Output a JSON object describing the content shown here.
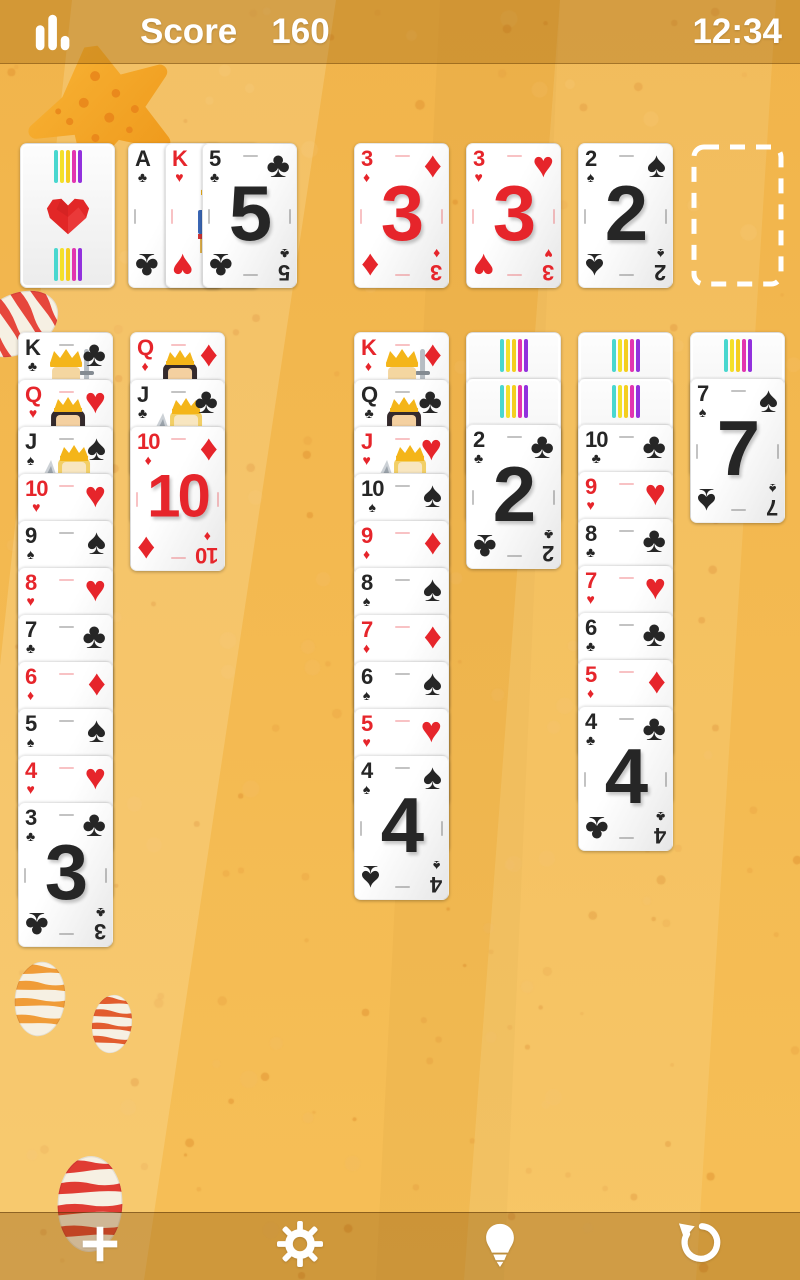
{
  "status_bar": {
    "stats_icon": "bar-chart-icon",
    "score_label": "Score",
    "score_value": "160",
    "time": "12:34"
  },
  "colors": {
    "background": "#f5bc55",
    "bar_overlay": "rgba(150,92,12,0.32)",
    "card_red": "#e6252b",
    "card_black": "#262626",
    "back_stripes": [
      "#49d7cf",
      "#f4e02a",
      "#f4ce1f",
      "#e234b0",
      "#9231dd"
    ],
    "back_heart": "#e22727",
    "empty_slot_dash": "#ffffff"
  },
  "stock": {
    "face_up": false,
    "design": "striped-back-red-heart"
  },
  "waste": [
    {
      "rank": "A",
      "suit": "clubs",
      "face_up": true
    },
    {
      "rank": "K",
      "suit": "hearts",
      "face_up": true
    },
    {
      "rank": "5",
      "suit": "clubs",
      "face_up": true
    }
  ],
  "foundations": [
    {
      "rank": "3",
      "suit": "diamonds",
      "face_up": true
    },
    {
      "rank": "3",
      "suit": "hearts",
      "face_up": true
    },
    {
      "rank": "2",
      "suit": "spades",
      "face_up": true
    },
    {
      "empty": true
    }
  ],
  "tableau": [
    [
      {
        "rank": "K",
        "suit": "clubs",
        "face_up": true
      },
      {
        "rank": "Q",
        "suit": "hearts",
        "face_up": true
      },
      {
        "rank": "J",
        "suit": "spades",
        "face_up": true
      },
      {
        "rank": "10",
        "suit": "hearts",
        "face_up": true
      },
      {
        "rank": "9",
        "suit": "spades",
        "face_up": true
      },
      {
        "rank": "8",
        "suit": "hearts",
        "face_up": true
      },
      {
        "rank": "7",
        "suit": "clubs",
        "face_up": true
      },
      {
        "rank": "6",
        "suit": "diamonds",
        "face_up": true
      },
      {
        "rank": "5",
        "suit": "spades",
        "face_up": true
      },
      {
        "rank": "4",
        "suit": "hearts",
        "face_up": true
      },
      {
        "rank": "3",
        "suit": "clubs",
        "face_up": true
      }
    ],
    [
      {
        "rank": "Q",
        "suit": "diamonds",
        "face_up": true
      },
      {
        "rank": "J",
        "suit": "clubs",
        "face_up": true
      },
      {
        "rank": "10",
        "suit": "diamonds",
        "face_up": true
      }
    ],
    [],
    [
      {
        "rank": "K",
        "suit": "diamonds",
        "face_up": true
      },
      {
        "rank": "Q",
        "suit": "clubs",
        "face_up": true
      },
      {
        "rank": "J",
        "suit": "hearts",
        "face_up": true
      },
      {
        "rank": "10",
        "suit": "spades",
        "face_up": true
      },
      {
        "rank": "9",
        "suit": "diamonds",
        "face_up": true
      },
      {
        "rank": "8",
        "suit": "spades",
        "face_up": true
      },
      {
        "rank": "7",
        "suit": "diamonds",
        "face_up": true
      },
      {
        "rank": "6",
        "suit": "spades",
        "face_up": true
      },
      {
        "rank": "5",
        "suit": "hearts",
        "face_up": true
      },
      {
        "rank": "4",
        "suit": "spades",
        "face_up": true
      }
    ],
    [
      {
        "face_up": false
      },
      {
        "face_up": false
      },
      {
        "rank": "2",
        "suit": "clubs",
        "face_up": true
      }
    ],
    [
      {
        "face_up": false
      },
      {
        "face_up": false
      },
      {
        "rank": "10",
        "suit": "clubs",
        "face_up": true
      },
      {
        "rank": "9",
        "suit": "hearts",
        "face_up": true
      },
      {
        "rank": "8",
        "suit": "clubs",
        "face_up": true
      },
      {
        "rank": "7",
        "suit": "hearts",
        "face_up": true
      },
      {
        "rank": "6",
        "suit": "clubs",
        "face_up": true
      },
      {
        "rank": "5",
        "suit": "diamonds",
        "face_up": true
      },
      {
        "rank": "4",
        "suit": "clubs",
        "face_up": true
      }
    ],
    [
      {
        "face_up": false
      },
      {
        "rank": "7",
        "suit": "spades",
        "face_up": true
      }
    ]
  ],
  "toolbar": {
    "buttons": [
      {
        "name": "new-game",
        "icon": "plus-icon"
      },
      {
        "name": "settings",
        "icon": "gear-icon"
      },
      {
        "name": "hint",
        "icon": "lightbulb-icon"
      },
      {
        "name": "undo",
        "icon": "undo-icon"
      }
    ]
  },
  "decorations": [
    "starfish",
    "striped-shell-left",
    "striped-shell-bottom-left-big",
    "striped-shell-bottom-left-small",
    "striped-shell-bottom"
  ]
}
